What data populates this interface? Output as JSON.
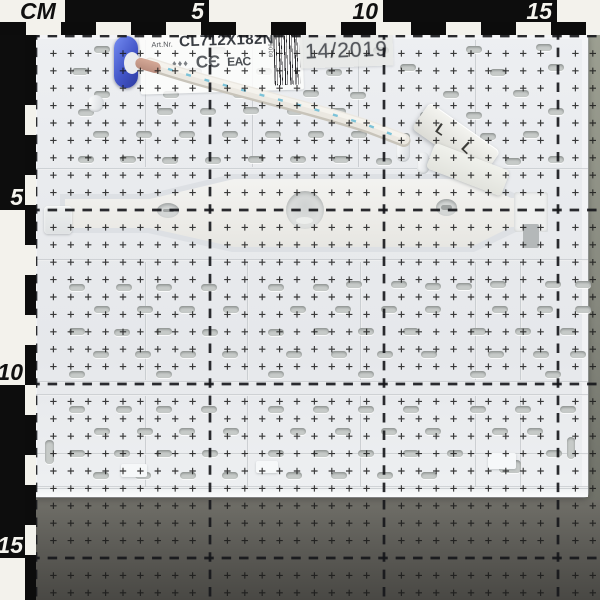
{
  "labels": {
    "art_prefix": "Art.Nr.",
    "art_code": "CL712X182N",
    "symbols": "♦♦♦",
    "ce_mark": "CЄ",
    "eac_mark": "ЕАС",
    "barcode_digits": "979008",
    "date_stamp": "14/2019",
    "terminal_marks": [
      "L",
      "L"
    ]
  },
  "rulers": {
    "unit_label": "CM",
    "top": {
      "segments": [
        {
          "x": 0,
          "w": 65,
          "bg": "light",
          "label": "CM"
        },
        {
          "x": 65,
          "w": 144,
          "bg": "dark",
          "label": "5"
        },
        {
          "x": 209,
          "w": 174,
          "bg": "light",
          "label": "10"
        },
        {
          "x": 383,
          "w": 174,
          "bg": "dark",
          "label": "15"
        },
        {
          "x": 557,
          "w": 43,
          "bg": "light",
          "label": ""
        }
      ],
      "ticks": [
        26,
        96,
        166,
        236,
        306,
        376,
        446,
        516,
        586
      ]
    },
    "left": {
      "segments": [
        {
          "y": 22,
          "h": 188,
          "bg": "dark",
          "label": "5"
        },
        {
          "y": 210,
          "h": 175,
          "bg": "light",
          "label": "10"
        },
        {
          "y": 385,
          "h": 173,
          "bg": "dark",
          "label": "15"
        },
        {
          "y": 558,
          "h": 42,
          "bg": "light",
          "label": ""
        }
      ],
      "ticks": [
        0,
        105,
        175,
        245,
        315,
        385,
        455,
        525
      ]
    }
  },
  "grid": {
    "origin_x": 36,
    "origin_y": 36,
    "pitch": 17.4,
    "major_every": 10,
    "count": 32,
    "cross_arm": 3.2,
    "cross_color": "#191919",
    "cross_opacity": 0.85,
    "lines_x": [
      36,
      210,
      384,
      558
    ],
    "lines_y": [
      36,
      210,
      384,
      558
    ],
    "dash_color": "#15161a",
    "dash_width": 2.7,
    "dash_array": "9.5 7.9",
    "dash_offset": 4.75
  },
  "panel": {
    "seams_v": [
      [
        145,
        40,
        167
      ],
      [
        252,
        40,
        167
      ],
      [
        358,
        40,
        167
      ],
      [
        475,
        40,
        167
      ],
      [
        145,
        262,
        380
      ],
      [
        247,
        262,
        380
      ],
      [
        360,
        262,
        380
      ],
      [
        475,
        262,
        380
      ],
      [
        520,
        262,
        380
      ],
      [
        145,
        396,
        487
      ],
      [
        247,
        396,
        487
      ],
      [
        360,
        396,
        487
      ],
      [
        475,
        396,
        487
      ],
      [
        520,
        396,
        487
      ]
    ],
    "seams_h": [
      168,
      259,
      381,
      394,
      453,
      486
    ],
    "ovals": [
      [
        157,
        203,
        22,
        15
      ],
      [
        436,
        199,
        21,
        17
      ]
    ],
    "patches": [
      [
        121,
        464,
        26,
        13
      ],
      [
        256,
        461,
        22,
        12
      ],
      [
        488,
        453,
        28,
        16
      ]
    ],
    "bosses": [
      [
        87,
        95,
        17,
        17
      ],
      [
        396,
        136,
        14,
        26
      ],
      [
        417,
        152,
        12,
        22
      ]
    ],
    "slots": [
      [
        94,
        46
      ],
      [
        210,
        47
      ],
      [
        281,
        46
      ],
      [
        373,
        47
      ],
      [
        466,
        46
      ],
      [
        536,
        44
      ],
      [
        72,
        68
      ],
      [
        116,
        68
      ],
      [
        186,
        68
      ],
      [
        256,
        68
      ],
      [
        326,
        69
      ],
      [
        400,
        64
      ],
      [
        490,
        69
      ],
      [
        548,
        64
      ],
      [
        94,
        91
      ],
      [
        163,
        91
      ],
      [
        233,
        91
      ],
      [
        303,
        90
      ],
      [
        350,
        92
      ],
      [
        443,
        91
      ],
      [
        513,
        90
      ],
      [
        78,
        109
      ],
      [
        157,
        108
      ],
      [
        200,
        108
      ],
      [
        243,
        107
      ],
      [
        287,
        108
      ],
      [
        330,
        108
      ],
      [
        420,
        112
      ],
      [
        466,
        112
      ],
      [
        548,
        108
      ],
      [
        93,
        131
      ],
      [
        136,
        131
      ],
      [
        179,
        131
      ],
      [
        222,
        131
      ],
      [
        265,
        131
      ],
      [
        308,
        131
      ],
      [
        351,
        131
      ],
      [
        394,
        133
      ],
      [
        437,
        133
      ],
      [
        480,
        133
      ],
      [
        523,
        131
      ],
      [
        78,
        156
      ],
      [
        120,
        156
      ],
      [
        162,
        157
      ],
      [
        205,
        157
      ],
      [
        248,
        156
      ],
      [
        290,
        156
      ],
      [
        333,
        156
      ],
      [
        376,
        158
      ],
      [
        419,
        158
      ],
      [
        462,
        158
      ],
      [
        505,
        158
      ],
      [
        548,
        156
      ],
      [
        69,
        284
      ],
      [
        116,
        284
      ],
      [
        156,
        284
      ],
      [
        201,
        284
      ],
      [
        268,
        284
      ],
      [
        313,
        284
      ],
      [
        346,
        281
      ],
      [
        391,
        281
      ],
      [
        425,
        283
      ],
      [
        456,
        283
      ],
      [
        490,
        281
      ],
      [
        545,
        281
      ],
      [
        575,
        281
      ],
      [
        94,
        306
      ],
      [
        137,
        306
      ],
      [
        179,
        306
      ],
      [
        223,
        306
      ],
      [
        290,
        306
      ],
      [
        335,
        306
      ],
      [
        381,
        306
      ],
      [
        425,
        306
      ],
      [
        492,
        306
      ],
      [
        537,
        306
      ],
      [
        575,
        306
      ],
      [
        69,
        328
      ],
      [
        114,
        329
      ],
      [
        156,
        328
      ],
      [
        202,
        329
      ],
      [
        268,
        329
      ],
      [
        313,
        328
      ],
      [
        358,
        328
      ],
      [
        403,
        328
      ],
      [
        470,
        328
      ],
      [
        515,
        328
      ],
      [
        560,
        328
      ],
      [
        93,
        351
      ],
      [
        135,
        351
      ],
      [
        180,
        351
      ],
      [
        222,
        351
      ],
      [
        286,
        351
      ],
      [
        331,
        351
      ],
      [
        377,
        351
      ],
      [
        421,
        351
      ],
      [
        488,
        351
      ],
      [
        533,
        351
      ],
      [
        570,
        351
      ],
      [
        69,
        371
      ],
      [
        156,
        371
      ],
      [
        268,
        371
      ],
      [
        358,
        371
      ],
      [
        470,
        371
      ],
      [
        545,
        371
      ],
      [
        69,
        406
      ],
      [
        116,
        406
      ],
      [
        156,
        406
      ],
      [
        201,
        406
      ],
      [
        268,
        406
      ],
      [
        313,
        406
      ],
      [
        358,
        406
      ],
      [
        403,
        406
      ],
      [
        470,
        406
      ],
      [
        515,
        406
      ],
      [
        560,
        406
      ],
      [
        94,
        428
      ],
      [
        137,
        428
      ],
      [
        179,
        428
      ],
      [
        223,
        428
      ],
      [
        290,
        428
      ],
      [
        335,
        428
      ],
      [
        381,
        428
      ],
      [
        425,
        428
      ],
      [
        492,
        428
      ],
      [
        527,
        428
      ],
      [
        69,
        450
      ],
      [
        114,
        450
      ],
      [
        156,
        450
      ],
      [
        202,
        450
      ],
      [
        268,
        450
      ],
      [
        313,
        450
      ],
      [
        358,
        450
      ],
      [
        403,
        450
      ],
      [
        447,
        450
      ],
      [
        546,
        450
      ],
      [
        93,
        472
      ],
      [
        135,
        472
      ],
      [
        180,
        472
      ],
      [
        222,
        472
      ],
      [
        286,
        472
      ],
      [
        331,
        472
      ],
      [
        377,
        472
      ],
      [
        421,
        472
      ],
      [
        567,
        437,
        8,
        22
      ],
      [
        45,
        440,
        9,
        24
      ],
      [
        499,
        460,
        22,
        13
      ]
    ]
  },
  "colors": {
    "panel_base": "#e9ebee",
    "slot": "#c6cac8",
    "mat_bottom": "#5b5a55",
    "mat_right": "#85877d",
    "ruler_black": "#0d0d0d",
    "ruler_white": "#f3f2ec",
    "grommet_blue": "#4356c8",
    "cable_white": "#ebe8e1",
    "stitch_blue": "#6fbed6",
    "wire_brown": "#c49a8b"
  }
}
